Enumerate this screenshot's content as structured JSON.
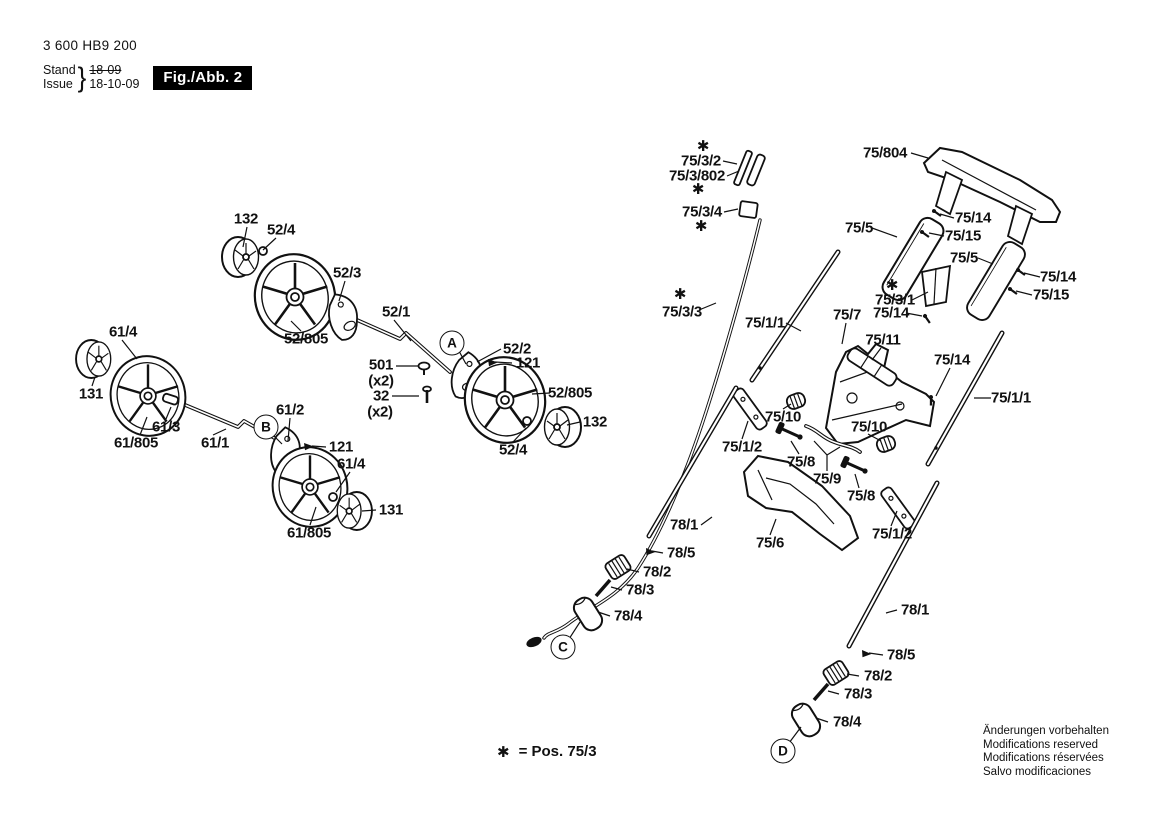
{
  "header": {
    "part_number": "3 600 HB9 200",
    "stand_label": "Stand",
    "issue_label": "Issue",
    "brace": "}",
    "old_date": "18-09",
    "date": "18-10-09",
    "figure_label": "Fig./Abb. 2"
  },
  "footnote": {
    "symbol": "✱",
    "text": "= Pos. 75/3"
  },
  "corner_notice": {
    "lines": [
      "Änderungen vorbehalten",
      "Modifications reserved",
      "Modifications réservées",
      "Salvo modificaciones"
    ]
  },
  "colors": {
    "ink": "#111111",
    "paper": "#ffffff"
  },
  "reference_circles": [
    {
      "label": "A",
      "x": 452,
      "y": 343
    },
    {
      "label": "B",
      "x": 266,
      "y": 427
    },
    {
      "label": "C",
      "x": 563,
      "y": 647
    },
    {
      "label": "D",
      "x": 783,
      "y": 751
    }
  ],
  "part_labels": [
    {
      "text": "132",
      "x": 246,
      "y": 219
    },
    {
      "text": "52/4",
      "x": 281,
      "y": 230
    },
    {
      "text": "52/3",
      "x": 347,
      "y": 273
    },
    {
      "text": "52/1",
      "x": 396,
      "y": 312
    },
    {
      "text": "52/805",
      "x": 306,
      "y": 339
    },
    {
      "text": "61/4",
      "x": 123,
      "y": 332
    },
    {
      "text": "131",
      "x": 91,
      "y": 394
    },
    {
      "text": "61/3",
      "x": 166,
      "y": 427
    },
    {
      "text": "61/805",
      "x": 136,
      "y": 443
    },
    {
      "text": "61/1",
      "x": 215,
      "y": 443
    },
    {
      "text": "61/2",
      "x": 290,
      "y": 410
    },
    {
      "text": "501",
      "x": 381,
      "y": 365
    },
    {
      "text": "(x2)",
      "x": 381,
      "y": 381
    },
    {
      "text": "32",
      "x": 381,
      "y": 396
    },
    {
      "text": "(x2)",
      "x": 380,
      "y": 412
    },
    {
      "text": "52/2",
      "x": 517,
      "y": 349
    },
    {
      "text": "121",
      "x": 528,
      "y": 363
    },
    {
      "text": "52/805",
      "x": 570,
      "y": 393
    },
    {
      "text": "132",
      "x": 595,
      "y": 422
    },
    {
      "text": "52/4",
      "x": 513,
      "y": 450
    },
    {
      "text": "121",
      "x": 341,
      "y": 447
    },
    {
      "text": "61/4",
      "x": 351,
      "y": 464
    },
    {
      "text": "131",
      "x": 391,
      "y": 510
    },
    {
      "text": "61/805",
      "x": 309,
      "y": 533
    },
    {
      "text": "✱",
      "x": 703,
      "y": 146
    },
    {
      "text": "75/3/2",
      "x": 701,
      "y": 161
    },
    {
      "text": "75/3/802",
      "x": 697,
      "y": 176
    },
    {
      "text": "✱",
      "x": 698,
      "y": 189
    },
    {
      "text": "75/3/4",
      "x": 702,
      "y": 212
    },
    {
      "text": "✱",
      "x": 701,
      "y": 226
    },
    {
      "text": "75/804",
      "x": 885,
      "y": 153
    },
    {
      "text": "75/14",
      "x": 973,
      "y": 218
    },
    {
      "text": "75/15",
      "x": 963,
      "y": 236
    },
    {
      "text": "75/5",
      "x": 859,
      "y": 228
    },
    {
      "text": "75/5",
      "x": 964,
      "y": 258
    },
    {
      "text": "75/14",
      "x": 1058,
      "y": 277
    },
    {
      "text": "75/15",
      "x": 1051,
      "y": 295
    },
    {
      "text": "✱",
      "x": 892,
      "y": 285
    },
    {
      "text": "75/3/1",
      "x": 895,
      "y": 300
    },
    {
      "text": "75/14",
      "x": 891,
      "y": 313
    },
    {
      "text": "✱",
      "x": 680,
      "y": 294
    },
    {
      "text": "75/3/3",
      "x": 682,
      "y": 312
    },
    {
      "text": "75/1/1",
      "x": 765,
      "y": 323
    },
    {
      "text": "75/7",
      "x": 847,
      "y": 315
    },
    {
      "text": "75/11",
      "x": 883,
      "y": 340
    },
    {
      "text": "75/14",
      "x": 952,
      "y": 360
    },
    {
      "text": "75/1/1",
      "x": 1011,
      "y": 398
    },
    {
      "text": "75/10",
      "x": 783,
      "y": 417
    },
    {
      "text": "75/10",
      "x": 869,
      "y": 427
    },
    {
      "text": "75/1/2",
      "x": 742,
      "y": 447
    },
    {
      "text": "75/8",
      "x": 801,
      "y": 462
    },
    {
      "text": "75/9",
      "x": 827,
      "y": 479
    },
    {
      "text": "75/8",
      "x": 861,
      "y": 496
    },
    {
      "text": "75/6",
      "x": 770,
      "y": 543
    },
    {
      "text": "75/1/2",
      "x": 892,
      "y": 534
    },
    {
      "text": "78/1",
      "x": 684,
      "y": 525
    },
    {
      "text": "78/5",
      "x": 681,
      "y": 553
    },
    {
      "text": "78/2",
      "x": 657,
      "y": 572
    },
    {
      "text": "78/3",
      "x": 640,
      "y": 590
    },
    {
      "text": "78/4",
      "x": 628,
      "y": 616
    },
    {
      "text": "78/1",
      "x": 915,
      "y": 610
    },
    {
      "text": "78/5",
      "x": 901,
      "y": 655
    },
    {
      "text": "78/2",
      "x": 878,
      "y": 676
    },
    {
      "text": "78/3",
      "x": 858,
      "y": 694
    },
    {
      "text": "78/4",
      "x": 847,
      "y": 722
    }
  ]
}
